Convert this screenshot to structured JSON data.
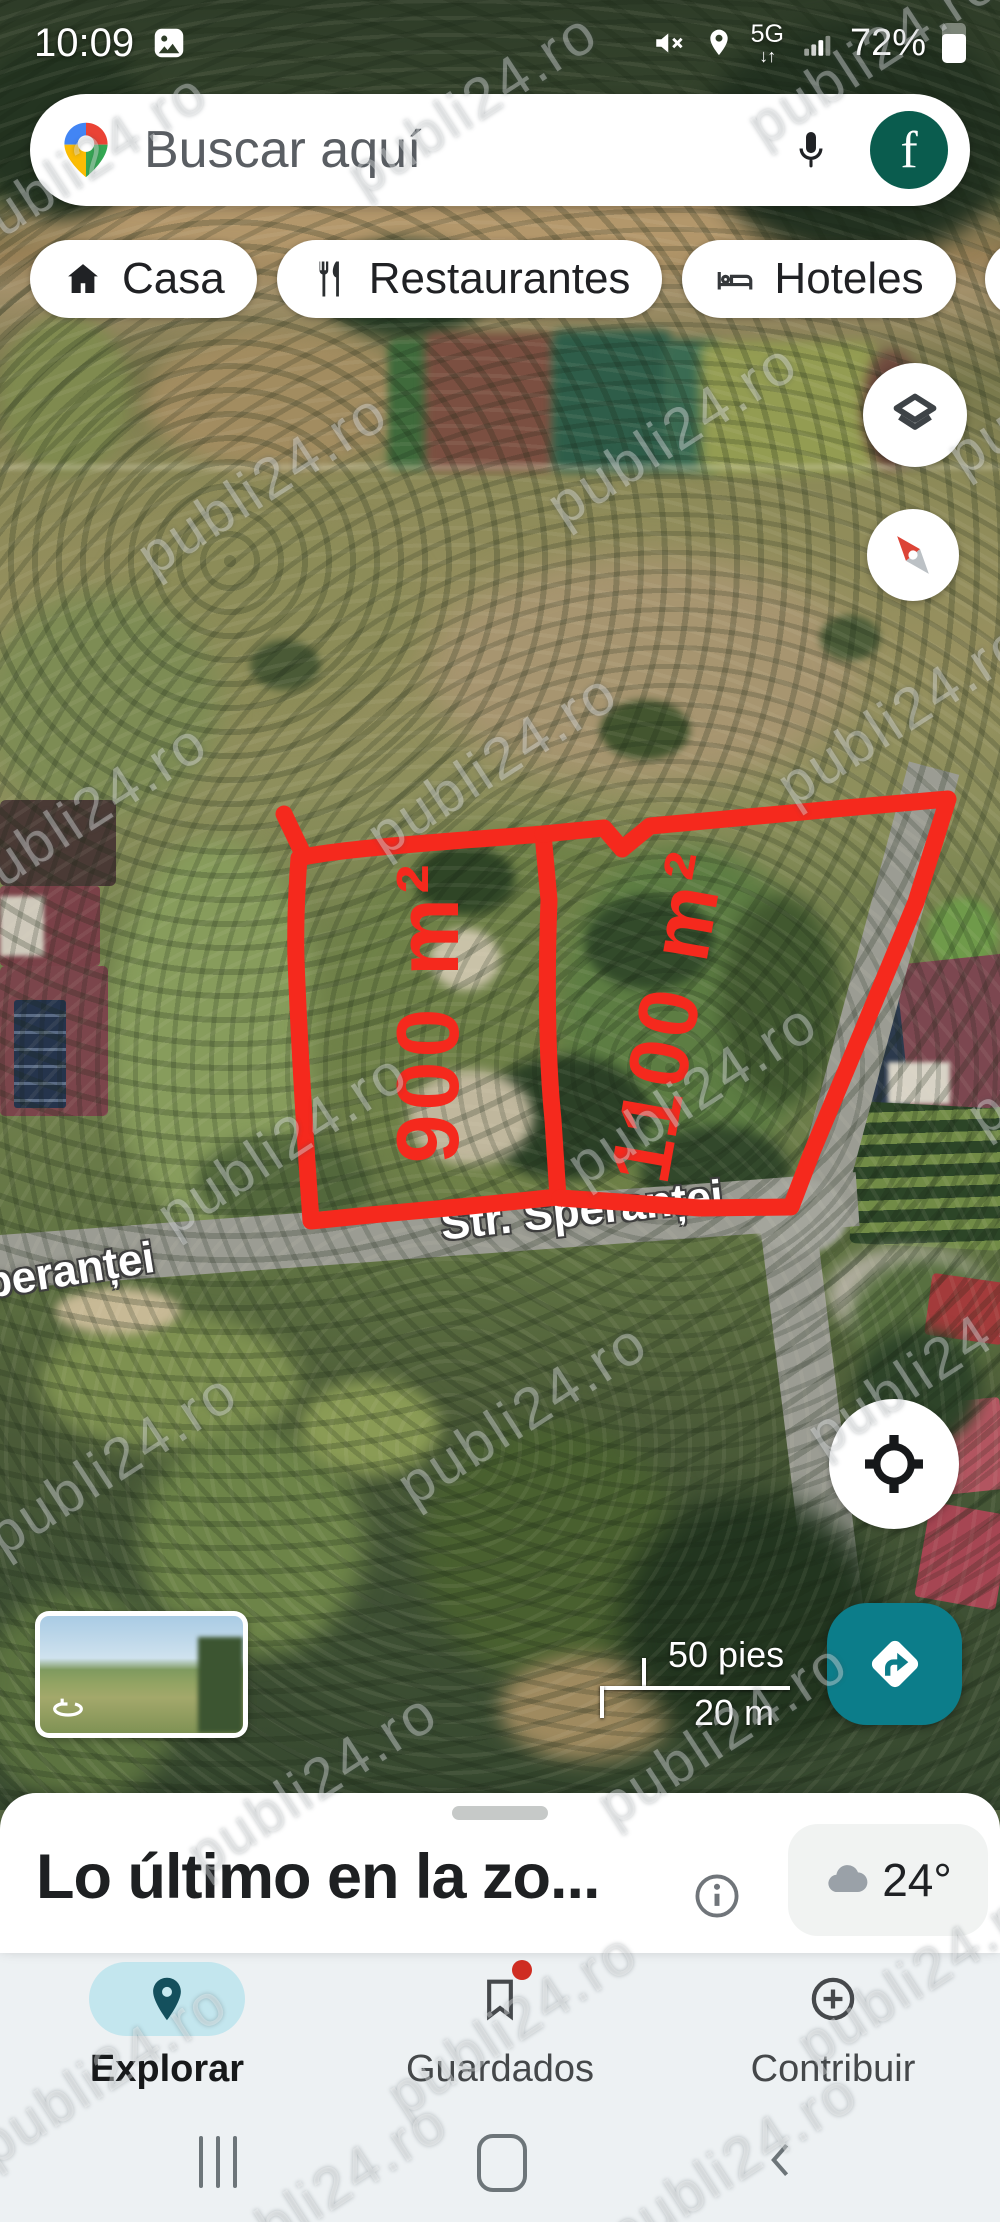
{
  "status_bar": {
    "time": "10:09",
    "network": "5G",
    "network_arrows": "↓↑",
    "battery_percent": "72%"
  },
  "search": {
    "placeholder": "Buscar aquí",
    "avatar_initial": "f"
  },
  "chips": [
    {
      "label": "Casa"
    },
    {
      "label": "Restaurantes"
    },
    {
      "label": "Hoteles"
    }
  ],
  "map": {
    "plot_left_area": "900 m²",
    "plot_right_area": "1100 m²",
    "street_label": "Str. Speranței",
    "street_label_partial": "peranței",
    "scale_imperial": "50 pies",
    "scale_metric": "20 m",
    "watermark": "publi24.ro"
  },
  "sheet": {
    "title": "Lo último en la zo...",
    "temperature": "24°"
  },
  "bottom_nav": {
    "explore": "Explorar",
    "saved": "Guardados",
    "contribute": "Contribuir"
  },
  "colors": {
    "annotation_red": "#f5291d",
    "fab_teal": "#0c7d8a",
    "active_pill": "#c3e6ee",
    "avatar_green": "#0a5c4e"
  }
}
